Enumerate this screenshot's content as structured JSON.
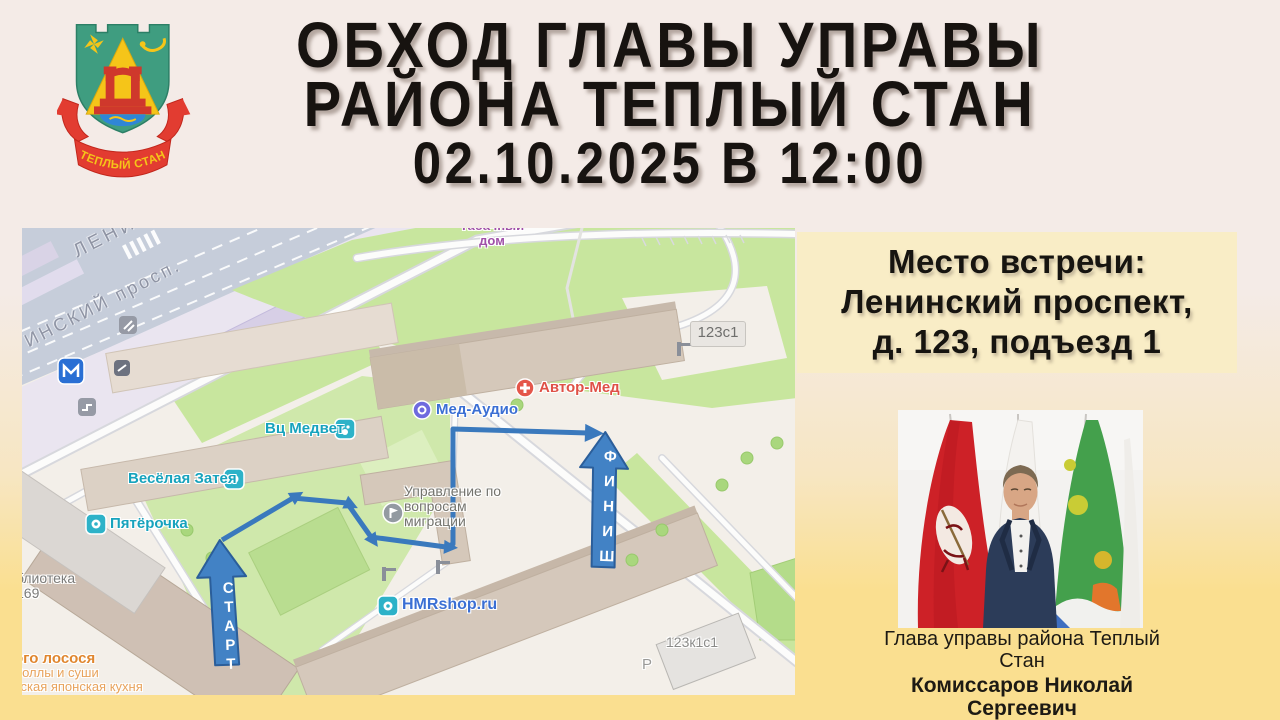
{
  "page": {
    "bg_top": "#f4ebe7",
    "bg_bottom": "#fadf90",
    "accent_route_color": "#3a79bd"
  },
  "header": {
    "line1": "ОБХОД ГЛАВЫ УПРАВЫ",
    "line2": "РАЙОНА ТЕПЛЫЙ СТАН",
    "line3": "02.10.2025 В 12:00"
  },
  "emblem": {
    "ribbon_text": "ТЕПЛЫЙ СТАН"
  },
  "meeting_panel": {
    "bg": "#f9edc6",
    "line1": "Место встречи:",
    "line2": "Ленинский проспект,",
    "line3": "д. 123, подъезд 1"
  },
  "map": {
    "street_top": "ЛЕНИН",
    "street_main": "ИНСКИЙ просп.",
    "route": {
      "start": "СТАРТ",
      "finish": "ФИНИШ",
      "color": "#3a79bd"
    },
    "pois": {
      "tabachny": "Табачный дом",
      "building_123s1": "123с1",
      "avtor_med": "Автор-Мед",
      "med_audio": "Мед-Аудио",
      "vc_medvet": "Вц Медвет",
      "veselaya": "Весёлая Затея",
      "pyaterochka": "Пятёрочка",
      "biblioteka_l1": "блиотека",
      "biblioteka_l2": "169",
      "upravlenie": "Управление по вопросам миграции",
      "hmrshop": "HMRshop.ru",
      "rolls_l1": "ого лосося",
      "rolls_l2": "Роллы и суши",
      "rolls_l3": "сская японская кухня",
      "building_123k1s1": "123к1с1",
      "parking": "Р"
    }
  },
  "official": {
    "role": "Глава управы района Теплый Стан",
    "name": "Комиссаров Николай Сергеевич"
  }
}
